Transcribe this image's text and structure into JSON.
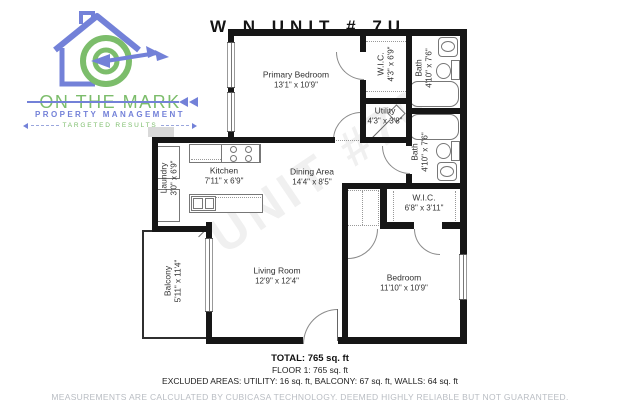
{
  "logo": {
    "brand": "ON THE MARK",
    "subtitle": "PROPERTY MANAGEMENT",
    "tagline": "TARGETED RESULTS"
  },
  "watermark": {
    "top": "W   N UNIT   # 7U",
    "diagonal": "UNIT #70"
  },
  "rooms": [
    {
      "name": "Primary Bedroom",
      "dims": "13'1\" x 10'9\""
    },
    {
      "name": "W.I.C.",
      "dims": "4'3\" x 6'9\""
    },
    {
      "name": "Bath",
      "dims": "4'10\" x 7'6\""
    },
    {
      "name": "Utility",
      "dims": "4'3\" x 3'8\""
    },
    {
      "name": "Bath",
      "dims": "4'10\" x 7'6\""
    },
    {
      "name": "Kitchen",
      "dims": "7'11\" x 6'9\""
    },
    {
      "name": "Laundry",
      "dims": "3'0\" x 6'9\""
    },
    {
      "name": "Dining Area",
      "dims": "14'4\" x 8'5\""
    },
    {
      "name": "Balcony",
      "dims": "5'11\" x 11'4\""
    },
    {
      "name": "Living Room",
      "dims": "12'9\" x 12'4\""
    },
    {
      "name": "Bedroom",
      "dims": "11'10\" x 10'9\""
    },
    {
      "name": "W.I.C.",
      "dims": "6'8\" x 3'11\""
    }
  ],
  "summary": {
    "total": "TOTAL: 765 sq. ft",
    "floor": "FLOOR 1: 765 sq. ft",
    "excluded": "EXCLUDED AREAS: UTILITY: 16 sq. ft, BALCONY: 67 sq. ft, WALLS: 64 sq. ft"
  },
  "disclaimer": "MEASUREMENTS ARE CALCULATED BY CUBICASA TECHNOLOGY. DEEMED HIGHLY RELIABLE BUT NOT GUARANTEED."
}
